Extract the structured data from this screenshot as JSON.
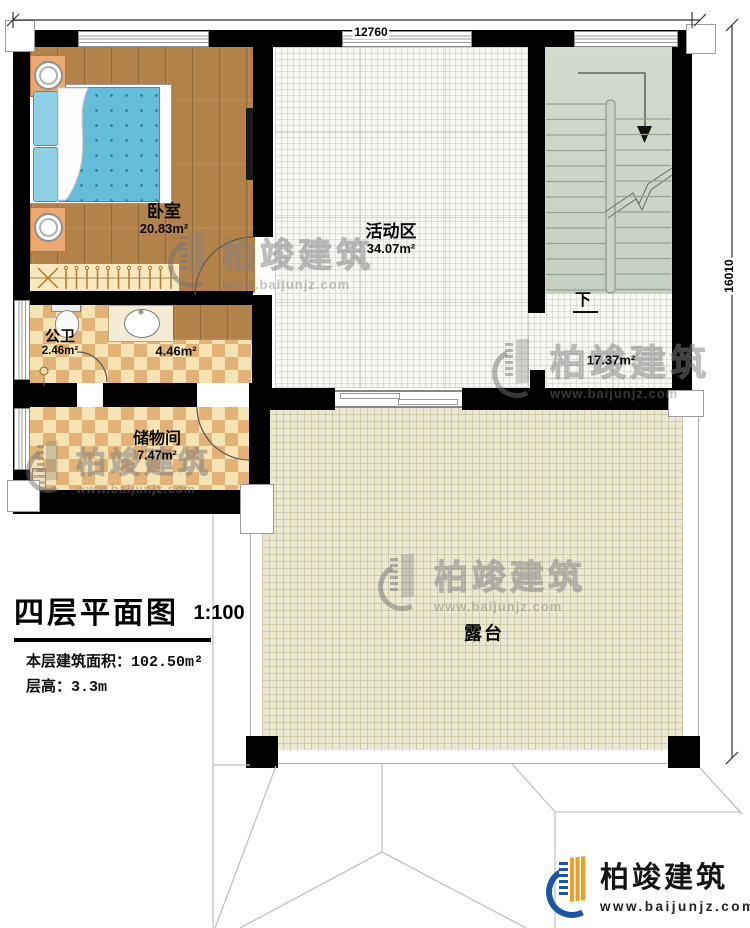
{
  "plan": {
    "title": "四层平面图",
    "scale": "1:100",
    "stats": [
      {
        "label": "本层建筑面积：",
        "value": "102.50m²"
      },
      {
        "label": "层高：",
        "value": "3.3m"
      }
    ],
    "dimensions": {
      "top": "12760",
      "right": "16010"
    },
    "rooms": {
      "bedroom": {
        "name": "卧室",
        "area": "20.83m²"
      },
      "activity": {
        "name": "活动区",
        "area": "34.07m²"
      },
      "toilet": {
        "name": "公卫",
        "area": "2.46m²"
      },
      "hall": {
        "area": "4.46m²"
      },
      "storage": {
        "name": "储物间",
        "area": "7.47m²"
      },
      "stair_hall": {
        "area": "17.37m²"
      },
      "terrace": {
        "name": "露台"
      },
      "stairs": {
        "down_label": "下"
      }
    }
  },
  "branding": {
    "company": "柏竣建筑",
    "website": "www.baijunjz.com"
  },
  "watermark": {
    "company": "柏竣建筑",
    "website": "www.baijunjz.com"
  },
  "colors": {
    "wall": "#000000",
    "wood": "#b2824a",
    "checker_dark": "#e2b277",
    "checker_light": "#f6e3b4",
    "tile": "#f7f7f3",
    "stairs": "#ccd5c8",
    "terrace": "#ebe8d3",
    "brand_blue": "#1d55a5",
    "brand_orange": "#f59d1e"
  }
}
